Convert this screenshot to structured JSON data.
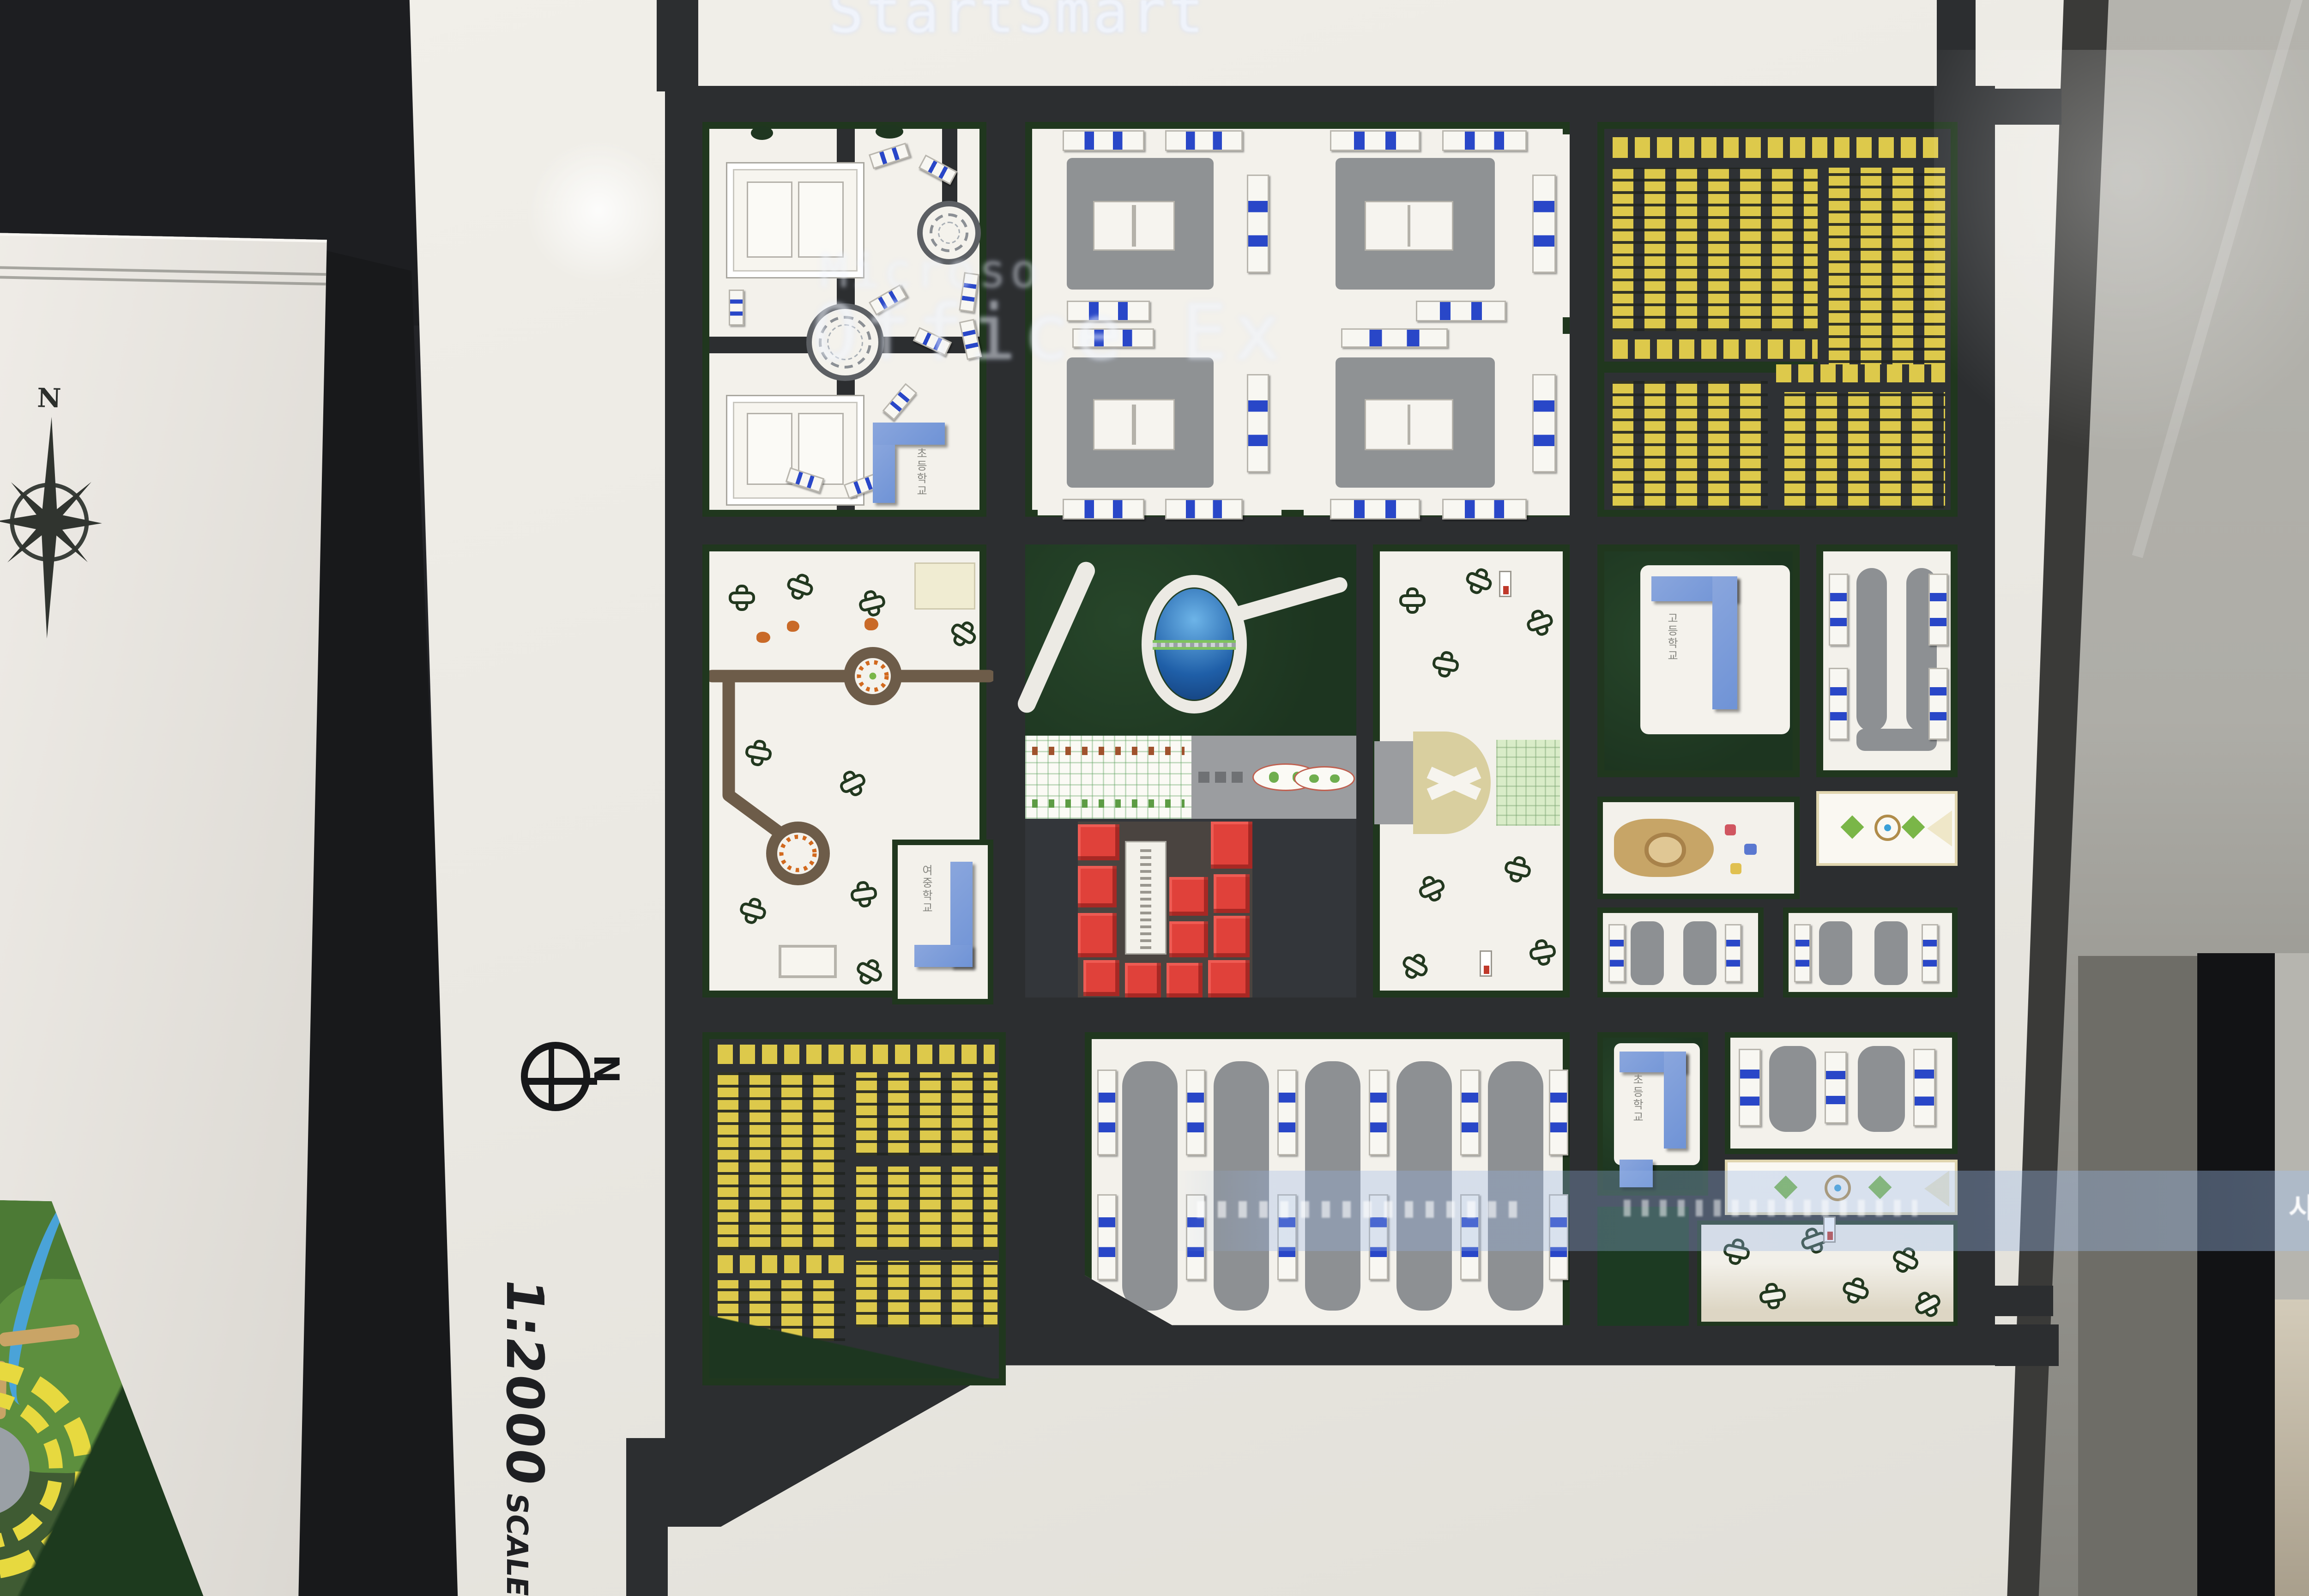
{
  "scene": {
    "description": "Photograph of a 1:2000-scale urban master plan architectural model mounted on white presentation boards, with projector text overlapping the boards"
  },
  "projection": {
    "title_text": "StartSmart",
    "brand_text": "Microso",
    "product_text": "Office Ex",
    "band_text_right": "시발표"
  },
  "main_board": {
    "north_label": "N",
    "scale_number": "1:2000",
    "scale_word": "SCALE"
  },
  "left_board": {
    "compass_label": "N"
  },
  "model": {
    "labels": {
      "school_nw": "초등학교",
      "school_park": "여중학교",
      "school_east": "고등학교",
      "school_se": "초등학교"
    },
    "blocks": [
      {
        "id": "office-campus-nw"
      },
      {
        "id": "apartment-courtyards-n"
      },
      {
        "id": "yellow-housing-ne"
      },
      {
        "id": "park-w"
      },
      {
        "id": "central-forest-pond-axis-red-civic"
      },
      {
        "id": "tree-plaza-center"
      },
      {
        "id": "school-and-apartments-e"
      },
      {
        "id": "yellow-housing-sw"
      },
      {
        "id": "rowhouse-strips-s"
      },
      {
        "id": "school-plaza-se"
      }
    ],
    "colors": {
      "road_tape": "#2c2e30",
      "board_white": "#edebe6",
      "housing_yellow": "#ddc94b",
      "apartment_gray": "#8d9093",
      "accent_blue_stripe": "#2947c8",
      "school_blue": "#7d9bd8",
      "civic_red": "#e0413a",
      "forest_green": "#20371e",
      "pond_blue": "#2e6fb5"
    }
  }
}
